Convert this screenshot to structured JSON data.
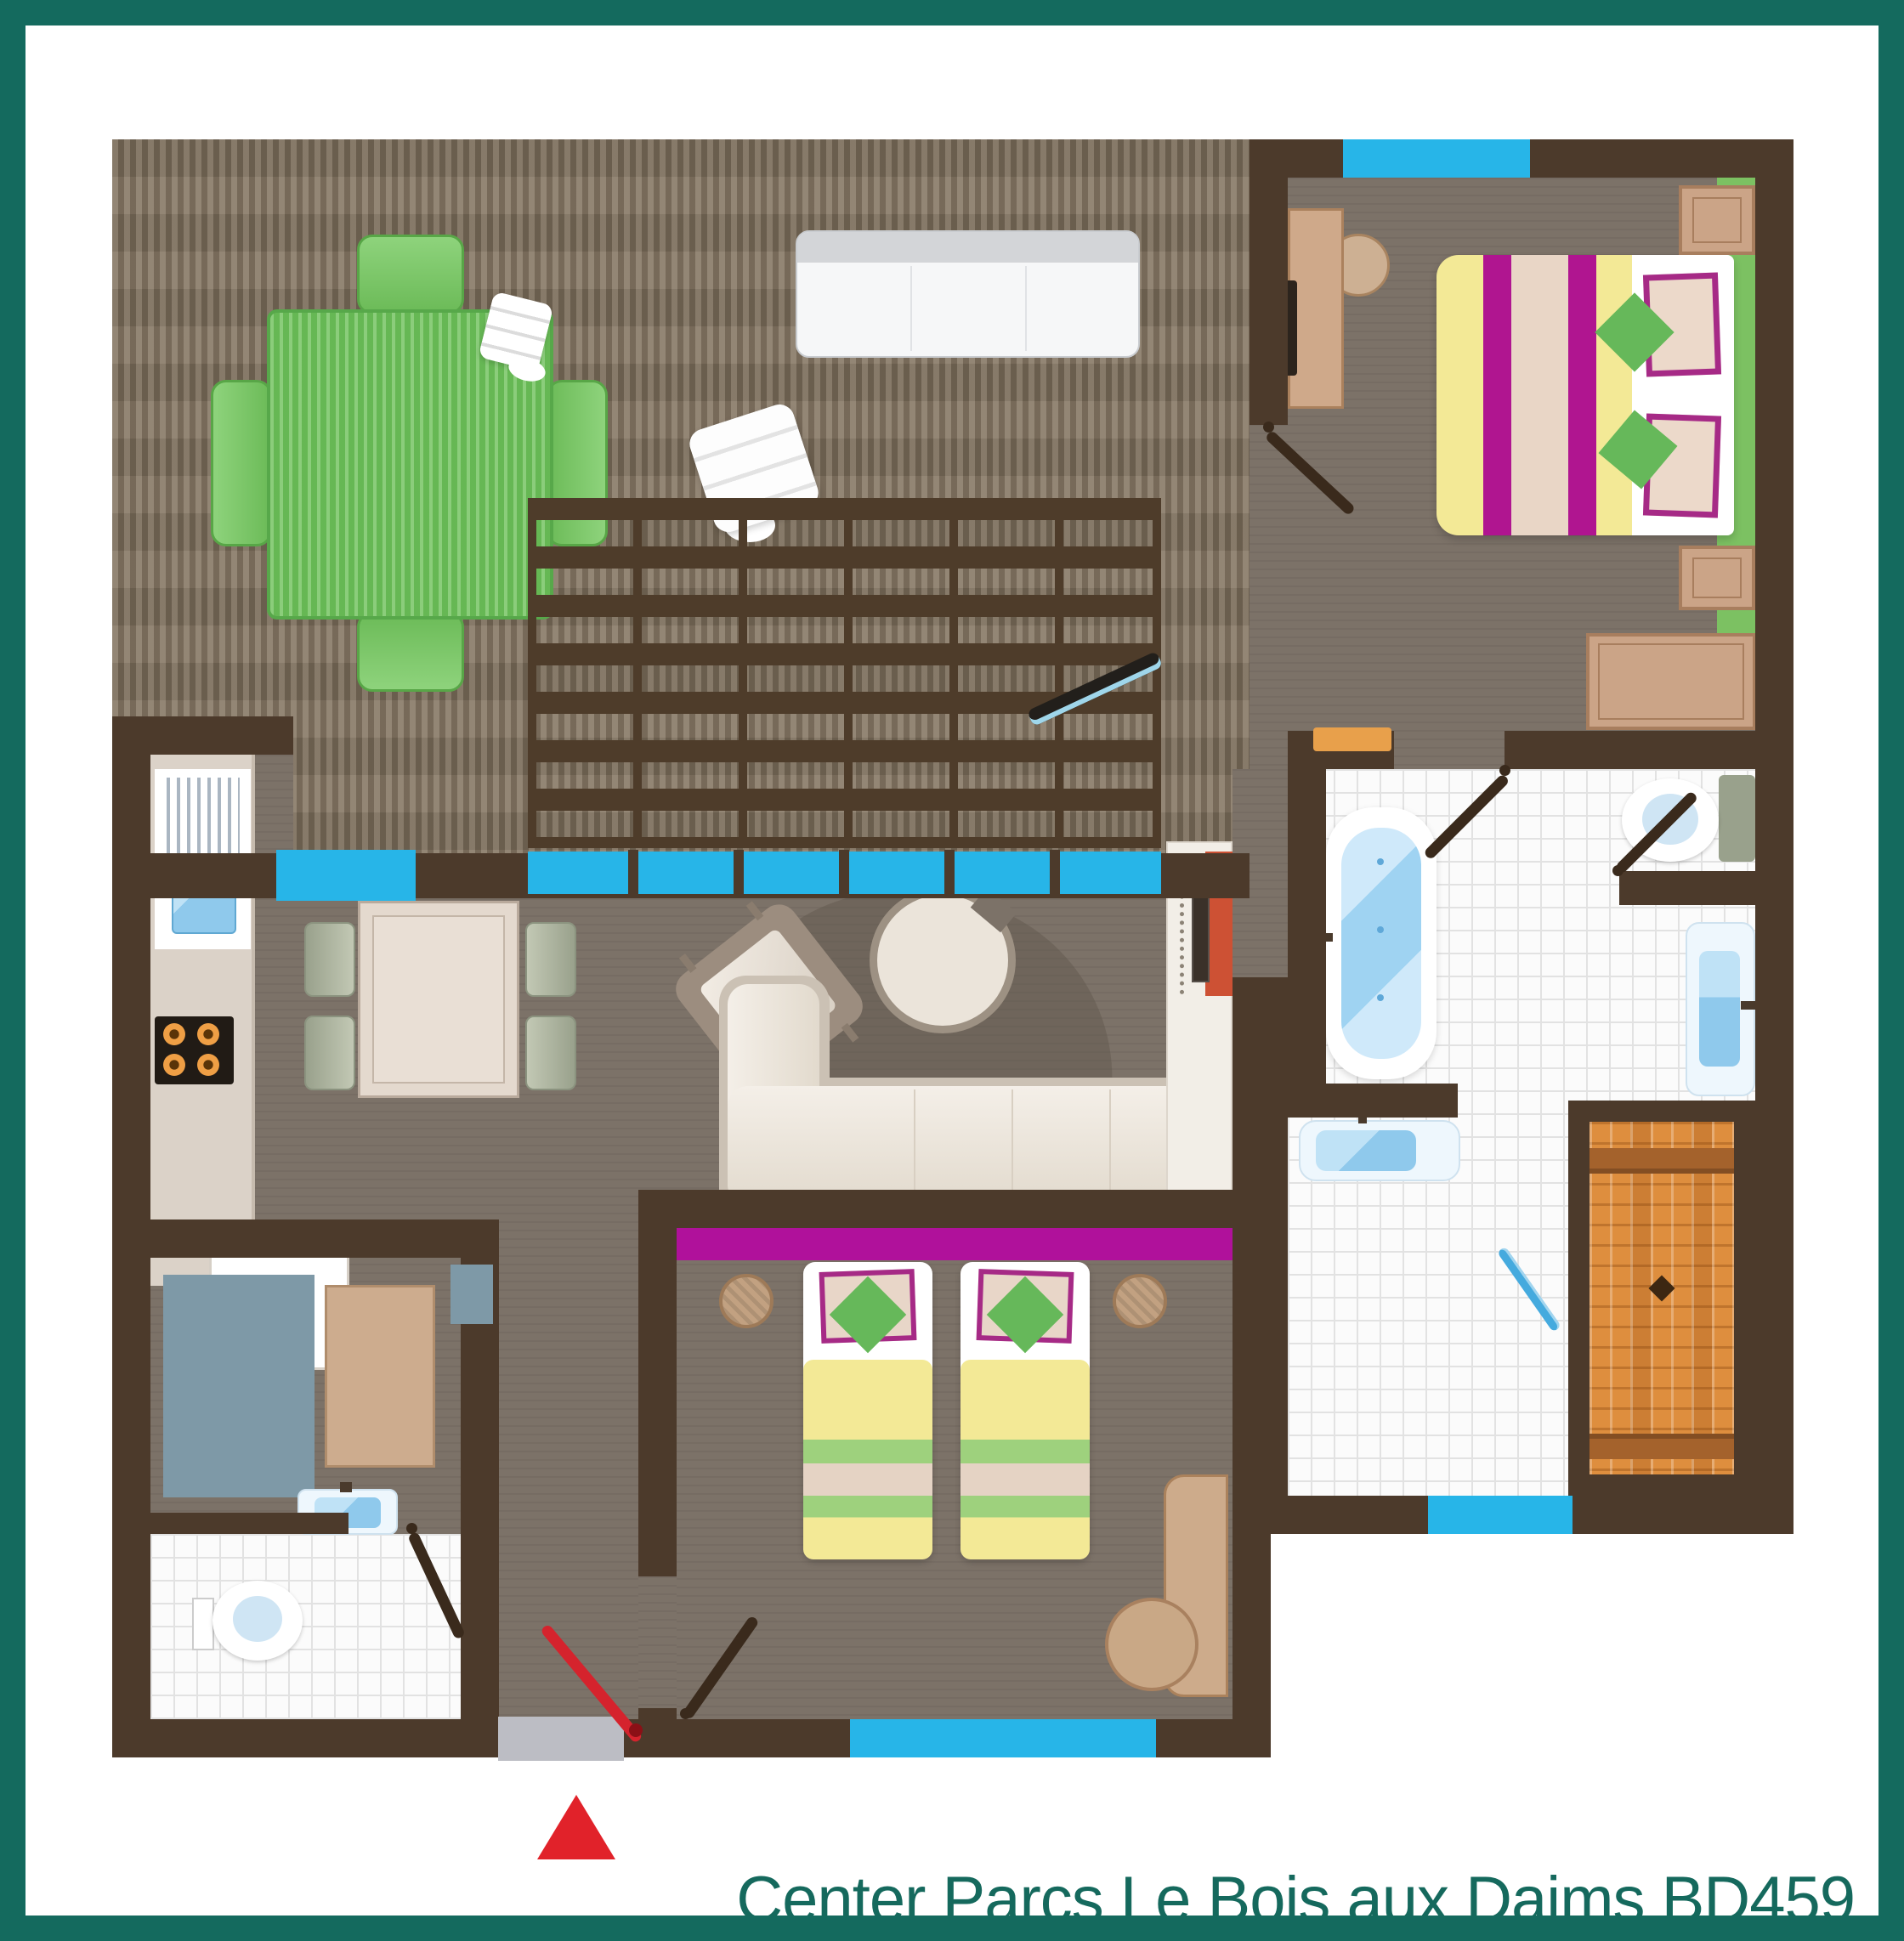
{
  "title": {
    "text": "Center Parcs Le Bois aux Daims BD459",
    "color": "#15695d"
  },
  "frame": {
    "color": "#146a5e",
    "thickness_px": 30
  },
  "palette": {
    "wall": "#4c3a2b",
    "deck_wood": "#82735f",
    "interior_floor": "#7c7268",
    "bathroom_tile": "#fbfbfb",
    "window_glazing": "#27b5e8",
    "magenta_accent": "#b0119b",
    "green_accent": "#6fbf5c",
    "duvet_yellow": "#f3e996",
    "furniture_tan": "#cba487",
    "sofa_cream": "#f0eae2",
    "water_blue": "#8fc9ec",
    "shower_orange": "#de8e3e",
    "entrance_red": "#d5232d",
    "picnic_table_green": "#72c25e"
  },
  "icons": {
    "entrance_arrow": "red triangle marking the entrance",
    "shower_squeegee": "blue squeegee glyph in bathroom",
    "sliding_door_leaf": "dark open sliding-door panel on terrace"
  }
}
